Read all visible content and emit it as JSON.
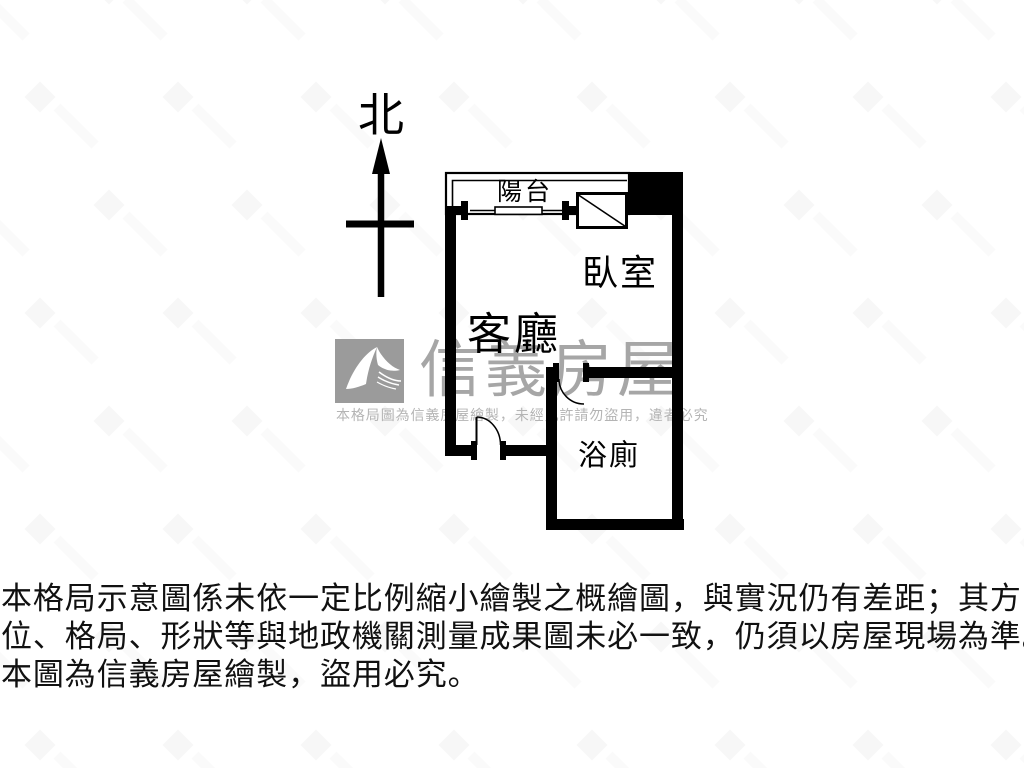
{
  "compass": {
    "north_label": "北"
  },
  "floorplan": {
    "rooms": {
      "balcony": "陽台",
      "bedroom": "臥室",
      "living_room": "客廳",
      "bathroom": "浴廁"
    }
  },
  "watermark": {
    "brand": "信義房屋",
    "notice": "本格局圖為信義房屋繪製，未經允許請勿盜用，違者必究",
    "brand_color": "#a6a6a6",
    "notice_color": "#b4b4b4",
    "logo_color": "#9b9b9b"
  },
  "disclaimer": {
    "line1": "本格局示意圖係未依一定比例縮小繪製之概繪圖，與實況仍有差距；其方",
    "line2": "位、格局、形狀等與地政機關測量成果圖未必一致，仍須以房屋現場為準。",
    "line3": "本圖為信義房屋繪製，盜用必究。",
    "text_color": "#111111"
  },
  "colors": {
    "plan_line": "#000000",
    "background": "#ffffff"
  }
}
